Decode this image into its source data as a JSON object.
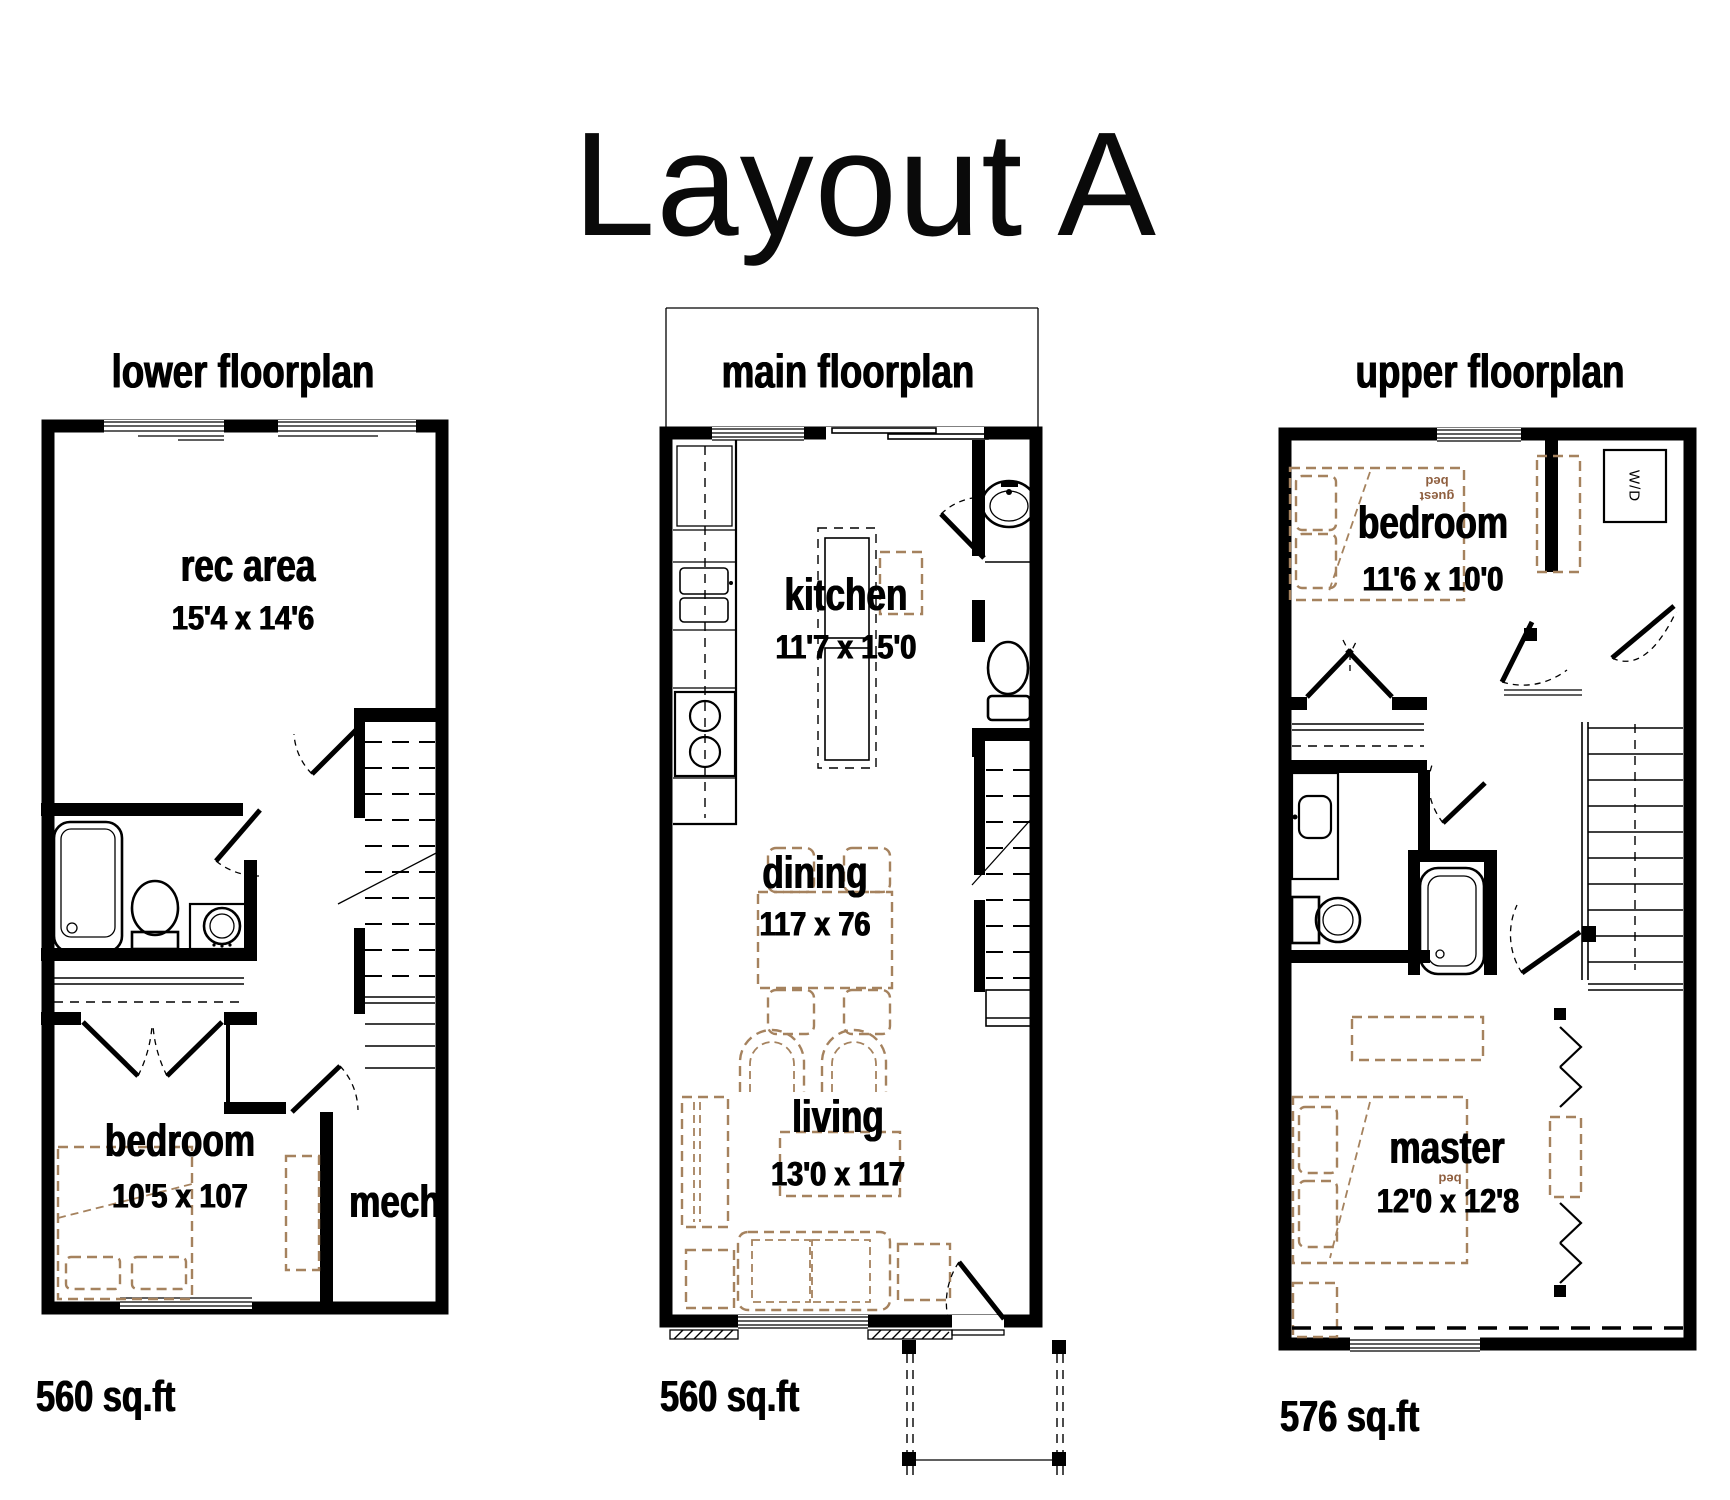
{
  "title": "Layout A",
  "colors": {
    "ink": "#000000",
    "furniture_tan": "#a5825e",
    "furniture_text": "#8f5f3f"
  },
  "plans": [
    {
      "id": "lower",
      "header": "lower floorplan",
      "sqft": "560 sq.ft",
      "rooms": [
        {
          "name": "rec  area",
          "dims": "15'4 x 14'6"
        },
        {
          "name": "bedroom",
          "dims": "10'5 x 107"
        },
        {
          "name": "mech",
          "dims": ""
        }
      ]
    },
    {
      "id": "main",
      "header": "main floorplan",
      "sqft": "560 sq.ft",
      "rooms": [
        {
          "name": "kitchen",
          "dims": "11'7 x 15'0"
        },
        {
          "name": "dining",
          "dims": "117 x 76"
        },
        {
          "name": "living",
          "dims": "13'0 x 117"
        }
      ]
    },
    {
      "id": "upper",
      "header": "upper floorplan",
      "sqft": "576 sq.ft",
      "rooms": [
        {
          "name": "bedroom",
          "dims": "11'6 x 10'0"
        },
        {
          "name": "master",
          "dims": "12'0 x 12'8"
        }
      ],
      "annotations": {
        "guest_bed": "guest bed",
        "bed": "bed",
        "washer_dryer": "W/D"
      }
    }
  ]
}
